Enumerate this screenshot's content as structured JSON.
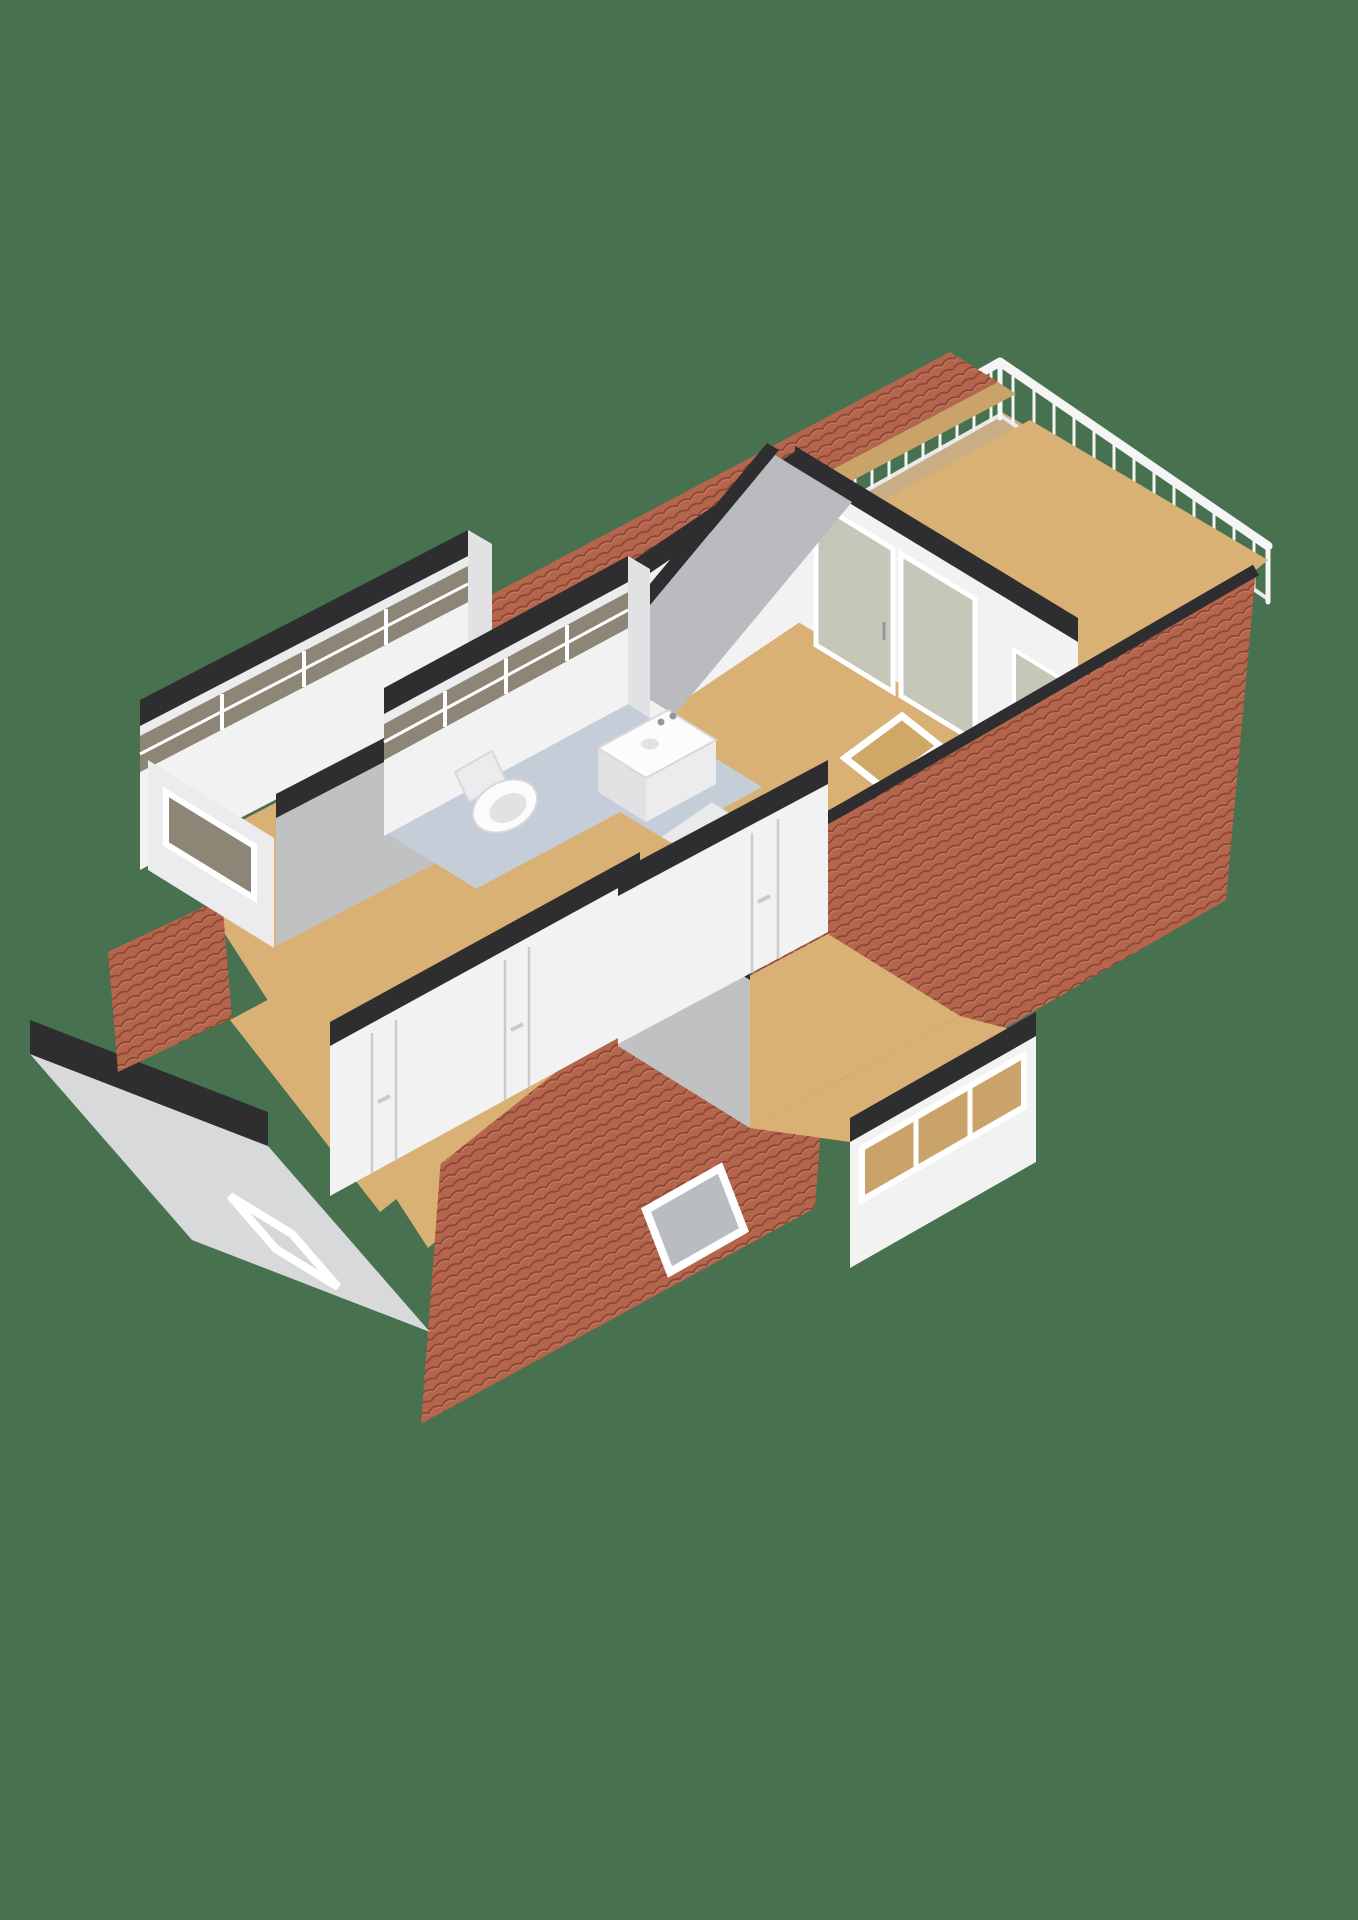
{
  "scene": {
    "type": "3d-floorplan-render",
    "view": "isometric-top-down",
    "storey": "attic-floor",
    "rooms": [
      {
        "id": "bedroom-large",
        "floor": "wood",
        "features": [
          "sliding-glass-doors-to-balcony",
          "roof-skylight"
        ]
      },
      {
        "id": "bedroom-left-narrow",
        "floor": "wood",
        "features": [
          "dormer-window-band",
          "gable-window"
        ]
      },
      {
        "id": "bedroom-bottom",
        "floor": "wood",
        "features": [
          "two-interior-doors",
          "gable-window"
        ]
      },
      {
        "id": "bedroom-small",
        "floor": "wood",
        "features": [
          "interior-door",
          "dormer-window-band"
        ]
      },
      {
        "id": "bathroom",
        "floor": "tile-blue-gray",
        "fixtures": [
          "toilet",
          "washbasin-vanity"
        ]
      },
      {
        "id": "landing",
        "floor": "wood",
        "features": [
          "sloped-ceiling-skylight"
        ]
      },
      {
        "id": "balcony",
        "floor": "decking",
        "features": [
          "white-balustrade-railing"
        ]
      }
    ],
    "exterior_features": [
      "brick-tiled-mansard-roof",
      "dark-cut-wall-caps",
      "dormers",
      "roof-skylights",
      "gray-gable-end-wall"
    ]
  },
  "palette": {
    "background": "#47714f",
    "wall_white": "#f2f2f3",
    "wall_light": "#ececee",
    "wall_shaded": "#d8d9da",
    "wall_gray": "#bfc1c3",
    "wall_gray_dark": "#b9bbbe",
    "wall_cap": "#2e2e30",
    "floor_wood": "#d9b175",
    "floor_wood_deep": "#cfa868",
    "balcony_floor": "#c8ad85",
    "eave_tan": "#c9a36a",
    "bathroom_floor": "#c5cdd9",
    "brick_base": "#b5654c",
    "brick_line": "#8a4636",
    "brick_light": "#c98b72",
    "glass_dark": "#8d8676",
    "glass_light": "#c6c7b8",
    "glass_sky": "#d6d7d9",
    "skylight_glass": "#b9bcc0",
    "skylight_inner": "#f4f5f6",
    "frame_white": "#ffffff",
    "railing_white": "#f5f5f5",
    "railing_soft": "#e9e9e9",
    "fixture_white": "#fcfcfd",
    "fixture_shadow": "#e2e2e5",
    "fixture_edge": "#d8d8db",
    "door_line": "#c9cbcd",
    "handle_gray": "#97979b",
    "slope_plane": "#e9eaeb"
  }
}
